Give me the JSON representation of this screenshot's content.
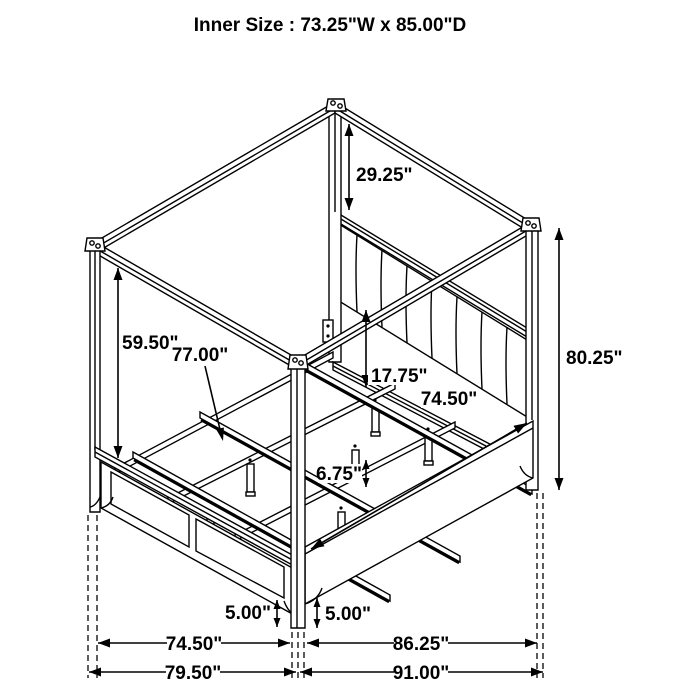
{
  "title": "Inner Size : 73.25\"W x 85.00\"D",
  "dims": {
    "canopy_drop": "29.25\"",
    "post_height": "59.50\"",
    "slat_length": "77.00\"",
    "headboard_gap": "17.75\"",
    "side_rail": "74.50\"",
    "overall_height": "80.25\"",
    "leg_height": "6.75\"",
    "foot_clearance_left": "5.00\"",
    "foot_clearance_right": "5.00\"",
    "width_inner": "74.50\"",
    "depth_inner": "86.25\"",
    "width_overall": "79.50\"",
    "depth_overall": "91.00\""
  }
}
